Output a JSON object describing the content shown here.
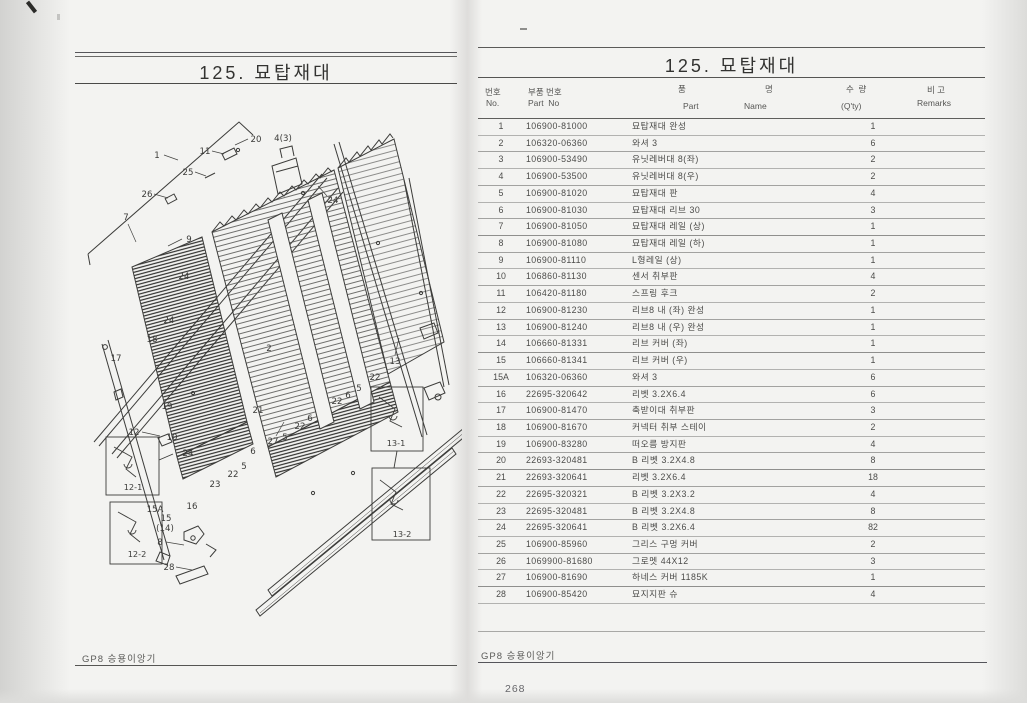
{
  "left": {
    "title": "125.  묘탑재대",
    "footer": "GP8 승용이앙기",
    "diagram": {
      "callouts": [
        {
          "n": "1",
          "x": 85,
          "y": 66,
          "leader": [
            92,
            63,
            106,
            68
          ]
        },
        {
          "n": "11",
          "x": 133,
          "y": 62,
          "leader": [
            140,
            59,
            152,
            62
          ]
        },
        {
          "n": "20",
          "x": 184,
          "y": 50,
          "leader": [
            176,
            47,
            163,
            53
          ]
        },
        {
          "n": "4(3)",
          "x": 211,
          "y": 49
        },
        {
          "n": "25",
          "x": 116,
          "y": 83,
          "leader": [
            123,
            80,
            134,
            84
          ]
        },
        {
          "n": "26",
          "x": 75,
          "y": 105,
          "leader": [
            82,
            102,
            96,
            106
          ]
        },
        {
          "n": "7",
          "x": 54,
          "y": 128,
          "leader": [
            56,
            132,
            64,
            150
          ]
        },
        {
          "n": "9",
          "x": 117,
          "y": 150,
          "leader": [
            110,
            147,
            96,
            154
          ]
        },
        {
          "n": "24",
          "x": 261,
          "y": 111,
          "leader": [
            255,
            104,
            246,
            94
          ]
        },
        {
          "n": "24",
          "x": 112,
          "y": 187
        },
        {
          "n": "24",
          "x": 97,
          "y": 231
        },
        {
          "n": "18",
          "x": 80,
          "y": 250
        },
        {
          "n": "17",
          "x": 44,
          "y": 269
        },
        {
          "n": "19",
          "x": 95,
          "y": 317
        },
        {
          "n": "12",
          "x": 62,
          "y": 343,
          "leader": [
            70,
            340,
            88,
            344
          ]
        },
        {
          "n": "10",
          "x": 100,
          "y": 348
        },
        {
          "n": "24",
          "x": 116,
          "y": 364
        },
        {
          "n": "2",
          "x": 197,
          "y": 259
        },
        {
          "n": "21",
          "x": 186,
          "y": 321
        },
        {
          "n": "23",
          "x": 143,
          "y": 395
        },
        {
          "n": "22",
          "x": 161,
          "y": 385
        },
        {
          "n": "5",
          "x": 172,
          "y": 377
        },
        {
          "n": "6",
          "x": 181,
          "y": 362
        },
        {
          "n": "27",
          "x": 201,
          "y": 352,
          "leader": [
            204,
            344,
            212,
            330
          ]
        },
        {
          "n": "5",
          "x": 213,
          "y": 348
        },
        {
          "n": "22",
          "x": 228,
          "y": 337
        },
        {
          "n": "6",
          "x": 238,
          "y": 329
        },
        {
          "n": "22",
          "x": 265,
          "y": 312
        },
        {
          "n": "6",
          "x": 276,
          "y": 306
        },
        {
          "n": "5",
          "x": 287,
          "y": 299
        },
        {
          "n": "22",
          "x": 303,
          "y": 288
        },
        {
          "n": "13",
          "x": 323,
          "y": 272,
          "leader": [
            323,
            263,
            327,
            246
          ]
        },
        {
          "n": "15A",
          "x": 83,
          "y": 420
        },
        {
          "n": "15",
          "x": 94,
          "y": 429
        },
        {
          "n": "(14)",
          "x": 93,
          "y": 439
        },
        {
          "n": "16",
          "x": 120,
          "y": 417
        },
        {
          "n": "8",
          "x": 88,
          "y": 453,
          "leader": [
            94,
            450,
            112,
            453
          ]
        },
        {
          "n": "28",
          "x": 97,
          "y": 478,
          "leader": [
            104,
            475,
            120,
            478
          ]
        },
        {
          "n": "12-1",
          "x": 61,
          "y": 398
        },
        {
          "n": "12-2",
          "x": 65,
          "y": 465
        },
        {
          "n": "13-1",
          "x": 324,
          "y": 354
        },
        {
          "n": "13-2",
          "x": 330,
          "y": 445
        }
      ]
    }
  },
  "right": {
    "title": "125.  묘탑재대",
    "footer": "GP8 승용이앙기",
    "page_number": "268",
    "table": {
      "headers": {
        "no_kr": "번호",
        "no_en": "No.",
        "part_no_kr": "부품 번호",
        "part_no_en": "Part  No",
        "name_kr_1": "품",
        "name_kr_2": "명",
        "name_en_1": "Part",
        "name_en_2": "Name",
        "qty_kr": "수  량",
        "qty_en": "(Q'ty)",
        "remarks_kr": "비 고",
        "remarks_en": "Remarks"
      },
      "rows": [
        {
          "no": "1",
          "part_no": "106900-81000",
          "name": "묘탑재대 완성",
          "qty": "1",
          "remarks": ""
        },
        {
          "no": "2",
          "part_no": "106320-06360",
          "name": "와셔 3",
          "qty": "6",
          "remarks": ""
        },
        {
          "no": "3",
          "part_no": "106900-53490",
          "name": "유닛레버대 8(좌)",
          "qty": "2",
          "remarks": ""
        },
        {
          "no": "4",
          "part_no": "106900-53500",
          "name": "유닛레버대 8(우)",
          "qty": "2",
          "remarks": ""
        },
        {
          "no": "5",
          "part_no": "106900-81020",
          "name": "묘탑재대 판",
          "qty": "4",
          "remarks": ""
        },
        {
          "no": "6",
          "part_no": "106900-81030",
          "name": "묘탑재대 리브 30",
          "qty": "3",
          "remarks": ""
        },
        {
          "no": "7",
          "part_no": "106900-81050",
          "name": "묘탑재대 레일 (상)",
          "qty": "1",
          "remarks": ""
        },
        {
          "no": "8",
          "part_no": "106900-81080",
          "name": "묘탑재대 레일 (하)",
          "qty": "1",
          "remarks": ""
        },
        {
          "no": "9",
          "part_no": "106900-81110",
          "name": "L형레일 (상)",
          "qty": "1",
          "remarks": ""
        },
        {
          "no": "10",
          "part_no": "106860-81130",
          "name": "센서 취부판",
          "qty": "4",
          "remarks": ""
        },
        {
          "no": "11",
          "part_no": "106420-81180",
          "name": "스프링 후크",
          "qty": "2",
          "remarks": ""
        },
        {
          "no": "12",
          "part_no": "106900-81230",
          "name": "리브8 내 (좌) 완성",
          "qty": "1",
          "remarks": ""
        },
        {
          "no": "13",
          "part_no": "106900-81240",
          "name": "리브8 내 (우) 완성",
          "qty": "1",
          "remarks": ""
        },
        {
          "no": "14",
          "part_no": "106660-81331",
          "name": "리브 커버 (좌)",
          "qty": "1",
          "remarks": ""
        },
        {
          "no": "15",
          "part_no": "106660-81341",
          "name": "리브 커버 (우)",
          "qty": "1",
          "remarks": ""
        },
        {
          "no": "15A",
          "part_no": "106320-06360",
          "name": "와셔 3",
          "qty": "6",
          "remarks": ""
        },
        {
          "no": "16",
          "part_no": "22695-320642",
          "name": "리벳 3.2X6.4",
          "qty": "6",
          "remarks": ""
        },
        {
          "no": "17",
          "part_no": "106900-81470",
          "name": "축받이대 취부판",
          "qty": "3",
          "remarks": ""
        },
        {
          "no": "18",
          "part_no": "106900-81670",
          "name": "커넥터 취부 스테이",
          "qty": "2",
          "remarks": ""
        },
        {
          "no": "19",
          "part_no": "106900-83280",
          "name": "떠오름 방지판",
          "qty": "4",
          "remarks": ""
        },
        {
          "no": "20",
          "part_no": "22693-320481",
          "name": "B 리벳 3.2X4.8",
          "qty": "8",
          "remarks": ""
        },
        {
          "no": "21",
          "part_no": "22693-320641",
          "name": "리벳 3.2X6.4",
          "qty": "18",
          "remarks": ""
        },
        {
          "no": "22",
          "part_no": "22695-320321",
          "name": "B 리벳 3.2X3.2",
          "qty": "4",
          "remarks": ""
        },
        {
          "no": "23",
          "part_no": "22695-320481",
          "name": "B 리벳 3.2X4.8",
          "qty": "8",
          "remarks": ""
        },
        {
          "no": "24",
          "part_no": "22695-320641",
          "name": "B 리벳 3.2X6.4",
          "qty": "82",
          "remarks": ""
        },
        {
          "no": "25",
          "part_no": "106900-85960",
          "name": "그리스 구멍 커버",
          "qty": "2",
          "remarks": ""
        },
        {
          "no": "26",
          "part_no": "1069900-81680",
          "name": "그로멧 44X12",
          "qty": "3",
          "remarks": ""
        },
        {
          "no": "27",
          "part_no": "106900-81690",
          "name": "하네스 커버 1185K",
          "qty": "1",
          "remarks": ""
        },
        {
          "no": "28",
          "part_no": "106900-85420",
          "name": "묘지지판 슈",
          "qty": "4",
          "remarks": ""
        }
      ]
    }
  },
  "colors": {
    "ink": "#3b3b39",
    "line_strong": "#55555",
    "line_light": "#b2b2b0",
    "paper": "#f3f3f1"
  }
}
